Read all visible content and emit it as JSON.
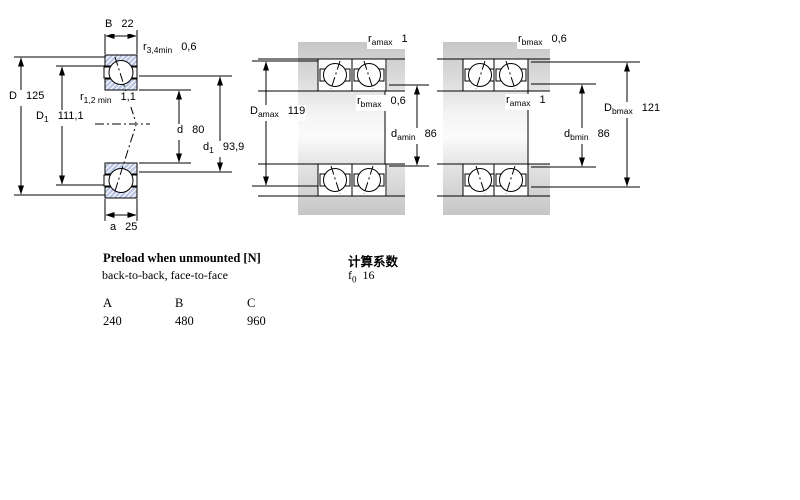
{
  "diagram": {
    "left": {
      "labels": {
        "B": {
          "base": "B",
          "sub": "",
          "value": "22"
        },
        "r34": {
          "base": "r",
          "sub": "3,4min",
          "value": "0,6"
        },
        "D": {
          "base": "D",
          "sub": "",
          "value": "125"
        },
        "D1": {
          "base": "D",
          "sub": "1",
          "value": "111,1"
        },
        "r12": {
          "base": "r",
          "sub": "1,2 min",
          "value": "1,1"
        },
        "d": {
          "base": "d",
          "sub": "",
          "value": "80"
        },
        "d1": {
          "base": "d",
          "sub": "1",
          "value": "93,9"
        },
        "a": {
          "base": "a",
          "sub": "",
          "value": "25"
        }
      }
    },
    "middle": {
      "labels": {
        "ramax": {
          "base": "r",
          "sub": "amax",
          "value": "1"
        },
        "rbmax": {
          "base": "r",
          "sub": "bmax",
          "value": "0,6"
        },
        "Damax": {
          "base": "D",
          "sub": "amax",
          "value": "119"
        },
        "damin": {
          "base": "d",
          "sub": "amin",
          "value": "86"
        }
      }
    },
    "right": {
      "labels": {
        "rbmax": {
          "base": "r",
          "sub": "bmax",
          "value": "0,6"
        },
        "ramax": {
          "base": "r",
          "sub": "amax",
          "value": "1"
        },
        "Dbmax": {
          "base": "D",
          "sub": "bmax",
          "value": "121"
        },
        "dbmin": {
          "base": "d",
          "sub": "bmin",
          "value": "86"
        }
      }
    }
  },
  "preload": {
    "title": "Preload when unmounted [N]",
    "subtitle": "back-to-back, face-to-face",
    "columns": [
      "A",
      "B",
      "C"
    ],
    "values": [
      "240",
      "480",
      "960"
    ]
  },
  "calc": {
    "title": "计算系数",
    "f_base": "f",
    "f_sub": "0",
    "f_value": "16"
  },
  "colors": {
    "ring_hatch_fill": "#b6c3e6",
    "block_gray": "#c7c7c7",
    "line": "#000000"
  }
}
